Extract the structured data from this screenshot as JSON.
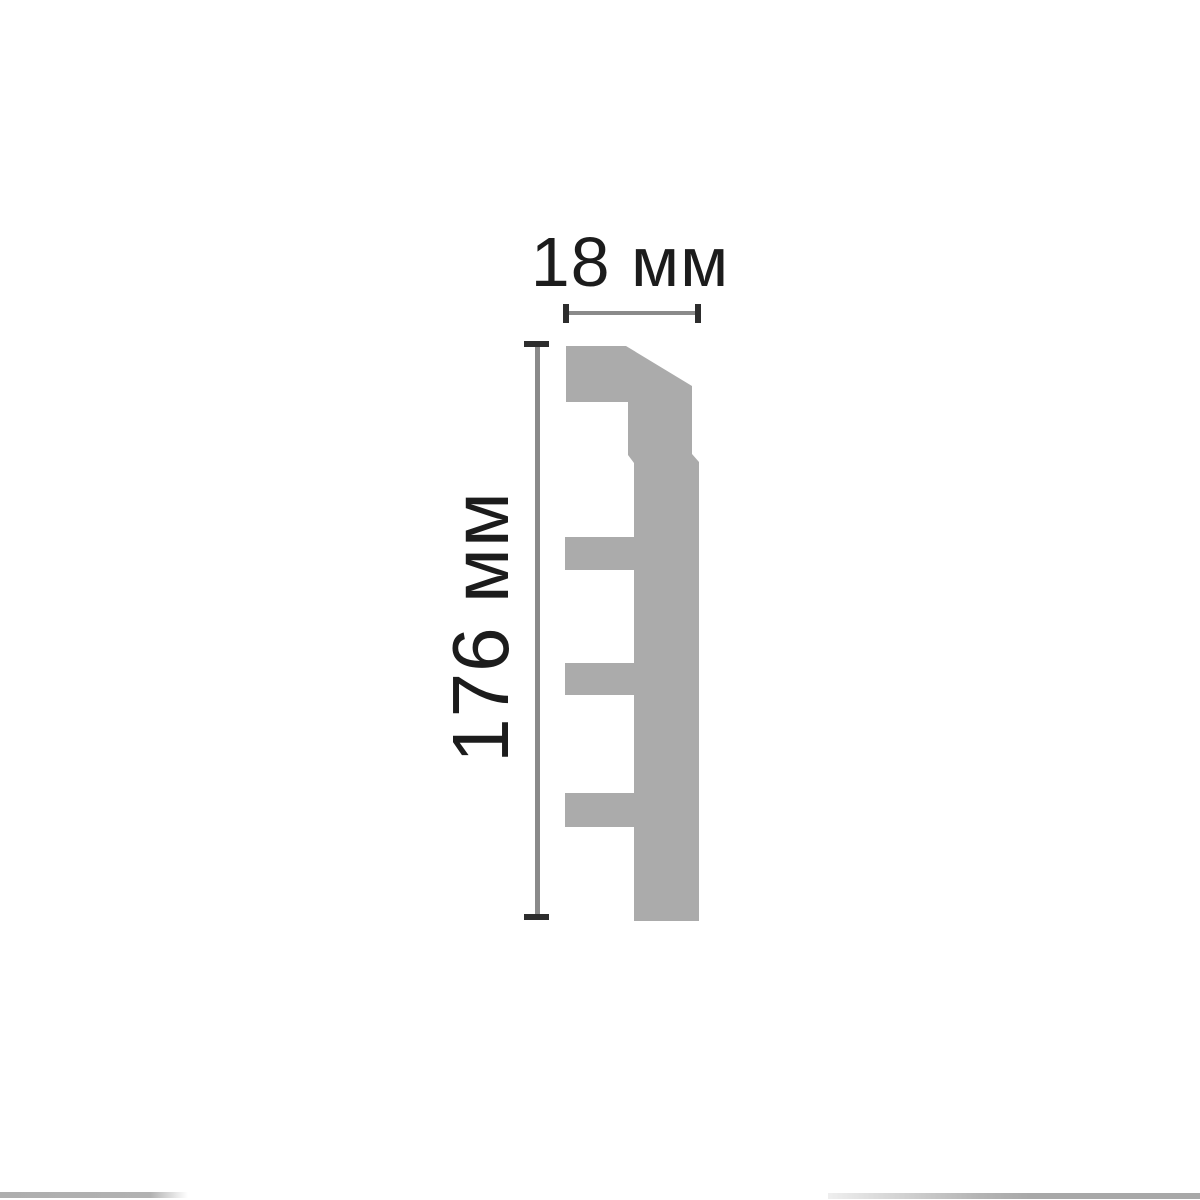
{
  "page": {
    "background": "#ffffff"
  },
  "diagram": {
    "width_dimension": {
      "label": "18 мм",
      "value": 18,
      "unit": "мм"
    },
    "height_dimension": {
      "label": "176 мм",
      "value": 176,
      "unit": "мм"
    },
    "profile": {
      "fill": "#ababab",
      "polygon_points": "566,346 626,346 692,386 692,454 699,462 699,921 634,921 634,827 565,827 565,793 634,793 634,695 565,695 565,663 634,663 634,570 565,570 565,537 634,537 634,463 628,455 628,402 566,402"
    },
    "colors": {
      "dimension_line": "#8a8a8a",
      "tick": "#2d2d2d",
      "label_text": "#1c1c1c"
    }
  }
}
